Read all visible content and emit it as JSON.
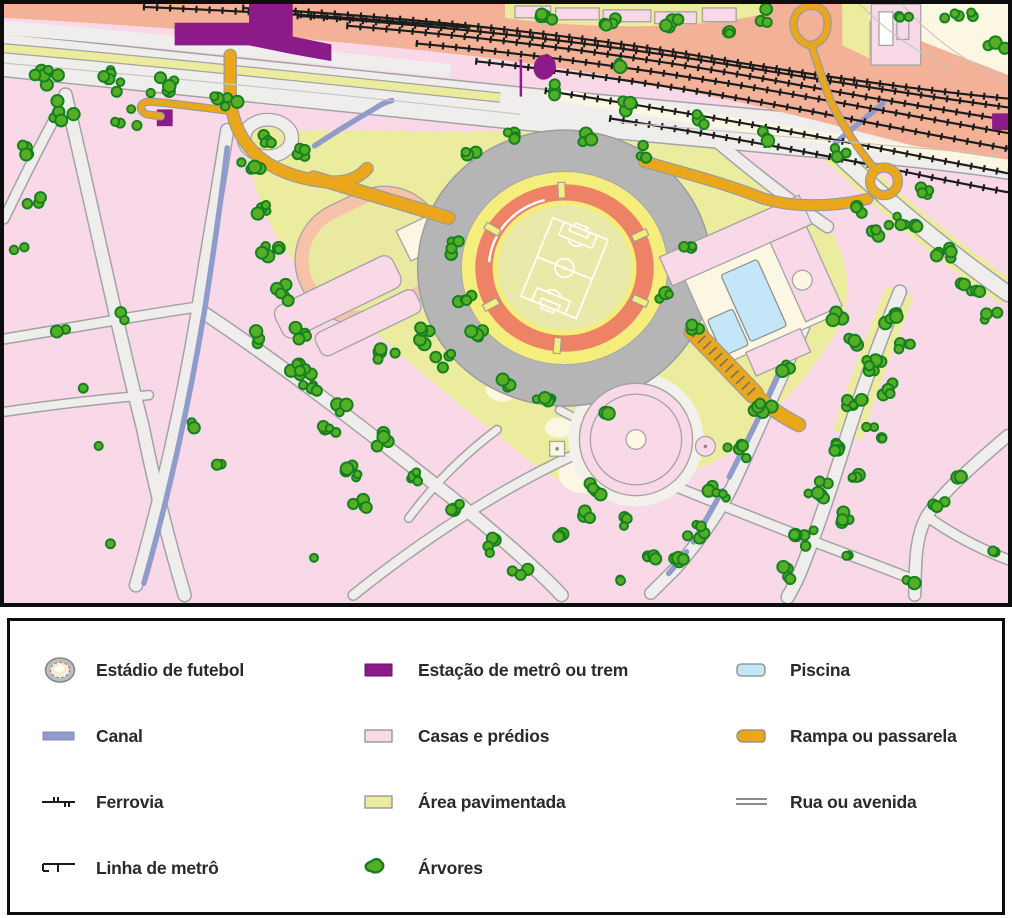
{
  "map": {
    "type": "illustrated-city-map",
    "depicts": [
      "football stadium with pitch",
      "athletics running track",
      "railway corridor with train tracks",
      "metro or train station",
      "houses and building blocks",
      "paved park areas",
      "swimming pools",
      "pedestrian ramps and walkways",
      "canals",
      "streets and avenues",
      "trees"
    ]
  },
  "legend": {
    "items": [
      {
        "id": "estadio-de-futebol",
        "label": "Estádio de futebol"
      },
      {
        "id": "canal",
        "label": "Canal"
      },
      {
        "id": "ferrovia",
        "label": "Ferrovia"
      },
      {
        "id": "linha-de-metro",
        "label": "Linha de metrô"
      },
      {
        "id": "estacao-de-metro-ou-trem",
        "label": "Estação de metrô ou trem"
      },
      {
        "id": "casas-e-predios",
        "label": "Casas e prédios"
      },
      {
        "id": "area-pavimentada",
        "label": "Área pavimentada"
      },
      {
        "id": "arvores",
        "label": "Árvores"
      },
      {
        "id": "piscina",
        "label": "Piscina"
      },
      {
        "id": "rampa-ou-passarela",
        "label": "Rampa ou passarela"
      },
      {
        "id": "rua-ou-avenida",
        "label": "Rua ou avenida"
      }
    ]
  },
  "colors": {
    "houses_pink": "#f9d8e8",
    "road_fill": "#efeeec",
    "road_edge": "#a3a3a3",
    "paved_yellow": "#ecec9f",
    "cream": "#fbf7e3",
    "rail_corridor": "#f3b197",
    "railway_black": "#1c1c1c",
    "station_purple": "#8c1a88",
    "ramp_orange": "#eba71b",
    "canal_blue": "#8e9bcb",
    "tree_fill": "#56ae27",
    "tree_stroke": "#15801f",
    "stadium_gray": "#b5b5b5",
    "stadium_yellow": "#f6ee7c",
    "stadium_track_red": "#ee8266",
    "stadium_field": "#e9e9a9",
    "running_track": "#f6c2aa",
    "pool_blue": "#c3e6f8",
    "field_lines": "#ffffff",
    "legend_text": "#2a2a2a",
    "border_black": "#0d0d0d"
  }
}
